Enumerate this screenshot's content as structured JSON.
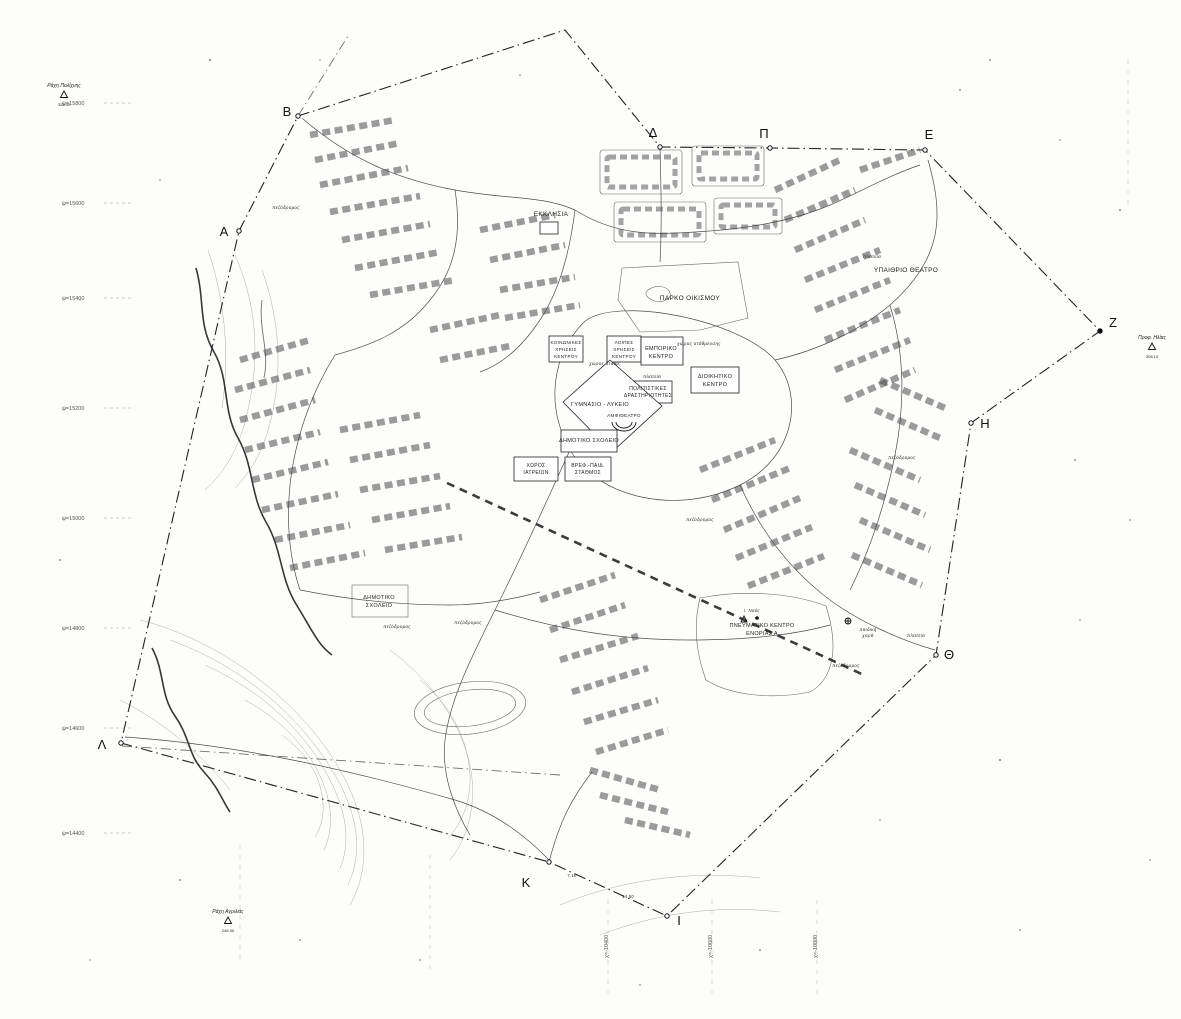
{
  "map": {
    "colors": {
      "paper": "#fdfdfc",
      "ink": "#1f1f1f",
      "contour": "#9a9a9a"
    },
    "boundary_vertices": [
      {
        "label": "A",
        "x": 239,
        "y": 231,
        "lx": 224,
        "ly": 236
      },
      {
        "label": "B",
        "x": 298,
        "y": 116,
        "lx": 287,
        "ly": 116
      },
      {
        "label": "Δ",
        "x": 660,
        "y": 147,
        "lx": 653,
        "ly": 137
      },
      {
        "label": "Π",
        "x": 770,
        "y": 148,
        "lx": 764,
        "ly": 138
      },
      {
        "label": "E",
        "x": 925,
        "y": 150,
        "lx": 929,
        "ly": 139
      },
      {
        "label": "Z",
        "x": 1100,
        "y": 331,
        "lx": 1113,
        "ly": 327
      },
      {
        "label": "H",
        "x": 971,
        "y": 423,
        "lx": 985,
        "ly": 428
      },
      {
        "label": "Θ",
        "x": 936,
        "y": 655,
        "lx": 949,
        "ly": 659
      },
      {
        "label": "I",
        "x": 667,
        "y": 916,
        "lx": 679,
        "ly": 925
      },
      {
        "label": "K",
        "x": 549,
        "y": 862,
        "lx": 526,
        "ly": 887
      },
      {
        "label": "Λ",
        "x": 121,
        "y": 743,
        "lx": 102,
        "ly": 749
      }
    ],
    "grid_labels_left": [
      {
        "t": "ψ=15800",
        "y": 105
      },
      {
        "t": "ψ=15600",
        "y": 205
      },
      {
        "t": "ψ=15400",
        "y": 300
      },
      {
        "t": "ψ=15200",
        "y": 410
      },
      {
        "t": "ψ=15000",
        "y": 520
      },
      {
        "t": "ψ=14800",
        "y": 630
      },
      {
        "t": "ψ=14600",
        "y": 730
      },
      {
        "t": "ψ=14400",
        "y": 835
      }
    ],
    "grid_labels_bottom": [
      {
        "t": "χ=-10400",
        "x": 608
      },
      {
        "t": "χ=-10600",
        "x": 712
      },
      {
        "t": "χ=-10800",
        "x": 817
      }
    ],
    "trig_points": [
      {
        "name": "Ράχη Πολίχνης",
        "elev": "322.40",
        "x": 64,
        "y": 95
      },
      {
        "name": "Προφ. Ηλίας",
        "elev": "308.10",
        "x": 1152,
        "y": 347
      },
      {
        "name": "Ράχη Αγριλιάς",
        "elev": "246.30",
        "x": 228,
        "y": 921
      }
    ],
    "labels": [
      {
        "t": "ΕΚΚΛΗΣΙΑ",
        "x": 551,
        "y": 216,
        "s": 6.5
      },
      {
        "t": "ΠΑΡΚΟ ΟΙΚΙΣΜΟΥ",
        "x": 690,
        "y": 300,
        "s": 6.5
      },
      {
        "t": "ΥΠΑΙΘΡΙΟ ΘΕΑΤΡΟ",
        "x": 906,
        "y": 272,
        "s": 6.5
      },
      {
        "t": "ΕΜΠΟΡΙΚΟ",
        "x": 661,
        "y": 350,
        "s": 5.5
      },
      {
        "t": "ΚΕΝΤΡΟ",
        "x": 661,
        "y": 358,
        "s": 5.5
      },
      {
        "t": "ΚΟΙΝΩΝΙΚΕΣ",
        "x": 566,
        "y": 344,
        "s": 4.6
      },
      {
        "t": "ΧΡΗΣΕΙΣ",
        "x": 566,
        "y": 351,
        "s": 4.6
      },
      {
        "t": "ΚΕΝΤΡΟΥ",
        "x": 566,
        "y": 358,
        "s": 4.6
      },
      {
        "t": "ΛΟΙΠΕΣ",
        "x": 624,
        "y": 344,
        "s": 4.6
      },
      {
        "t": "ΧΡΗΣΕΙΣ",
        "x": 624,
        "y": 351,
        "s": 4.6
      },
      {
        "t": "ΚΕΝΤΡΟΥ",
        "x": 624,
        "y": 358,
        "s": 4.6
      },
      {
        "t": "ΔΙΟΙΚΗΤΙΚΟ",
        "x": 715,
        "y": 378,
        "s": 5.5
      },
      {
        "t": "ΚΕΝΤΡΟ",
        "x": 715,
        "y": 386,
        "s": 5.5
      },
      {
        "t": "ΠΟΛΙΤΙΣΤΙΚΕΣ",
        "x": 648,
        "y": 390,
        "s": 5
      },
      {
        "t": "ΔΡΑΣΤΗΡΙΟΤΗΤΕΣ",
        "x": 648,
        "y": 397,
        "s": 5
      },
      {
        "t": "ΓΥΜΝΑΣΙΟ - ΛΥΚΕΙΟ",
        "x": 600,
        "y": 406,
        "s": 5.5
      },
      {
        "t": "ΑΜΦΙΘΕΑΤΡΟ",
        "x": 624,
        "y": 417,
        "s": 4.6
      },
      {
        "t": "ΔΗΜΟΤΙΚΟ ΣΧΟΛΕΙΟ",
        "x": 589,
        "y": 442,
        "s": 5.5
      },
      {
        "t": "ΧΩΡΟΣ",
        "x": 536,
        "y": 467,
        "s": 5
      },
      {
        "t": "ΙΑΤΡΕΙΩΝ",
        "x": 536,
        "y": 474,
        "s": 5
      },
      {
        "t": "ΒΡΕΦ.-ΠΑΙΔ.",
        "x": 588,
        "y": 467,
        "s": 5
      },
      {
        "t": "ΣΤΑΘΜΟΣ",
        "x": 588,
        "y": 474,
        "s": 5
      },
      {
        "t": "ΔΗΜΟΤΙΚΟ",
        "x": 379,
        "y": 599,
        "s": 5.5
      },
      {
        "t": "ΣΧΟΛΕΙΟ",
        "x": 379,
        "y": 607,
        "s": 5.5
      },
      {
        "t": "ΠΝΕΥΜΑΤΙΚΟ ΚΕΝΤΡΟ",
        "x": 762,
        "y": 627,
        "s": 5.5
      },
      {
        "t": "ΕΝΟΡΙΑΣ Α",
        "x": 762,
        "y": 635,
        "s": 5.5
      },
      {
        "t": "χώρος στάθμευσης",
        "x": 699,
        "y": 345,
        "s": 4.6,
        "i": 1
      },
      {
        "t": "χώρος στάθμ.",
        "x": 605,
        "y": 365,
        "s": 4.6,
        "i": 1
      },
      {
        "t": "πλατεία",
        "x": 652,
        "y": 378,
        "s": 4.8,
        "i": 1
      },
      {
        "t": "πλατεία",
        "x": 872,
        "y": 258,
        "s": 4.8,
        "i": 1
      },
      {
        "t": "πλατεία",
        "x": 916,
        "y": 637,
        "s": 4.8,
        "i": 1
      },
      {
        "t": "παιδική",
        "x": 868,
        "y": 631,
        "s": 4.6,
        "i": 1
      },
      {
        "t": "χαρά",
        "x": 868,
        "y": 637,
        "s": 4.6,
        "i": 1
      },
      {
        "t": "πεζόδρομος",
        "x": 286,
        "y": 209,
        "s": 4.6,
        "i": 1
      },
      {
        "t": "πεζόδρομος",
        "x": 397,
        "y": 628,
        "s": 4.6,
        "i": 1
      },
      {
        "t": "πεζόδρομος",
        "x": 468,
        "y": 624,
        "s": 4.6,
        "i": 1
      },
      {
        "t": "πεζόδρομος",
        "x": 846,
        "y": 667,
        "s": 4.6,
        "i": 1
      },
      {
        "t": "πεζόδρομος",
        "x": 700,
        "y": 521,
        "s": 4.6,
        "i": 1
      },
      {
        "t": "πεζόδρομος",
        "x": 902,
        "y": 459,
        "s": 4.6,
        "i": 1
      },
      {
        "t": "Ι. Ναός",
        "x": 752,
        "y": 612,
        "s": 4.4,
        "i": 1
      },
      {
        "t": "7.10",
        "x": 572,
        "y": 877,
        "s": 4.2
      },
      {
        "t": "14.50",
        "x": 628,
        "y": 898,
        "s": 4.2
      }
    ]
  }
}
